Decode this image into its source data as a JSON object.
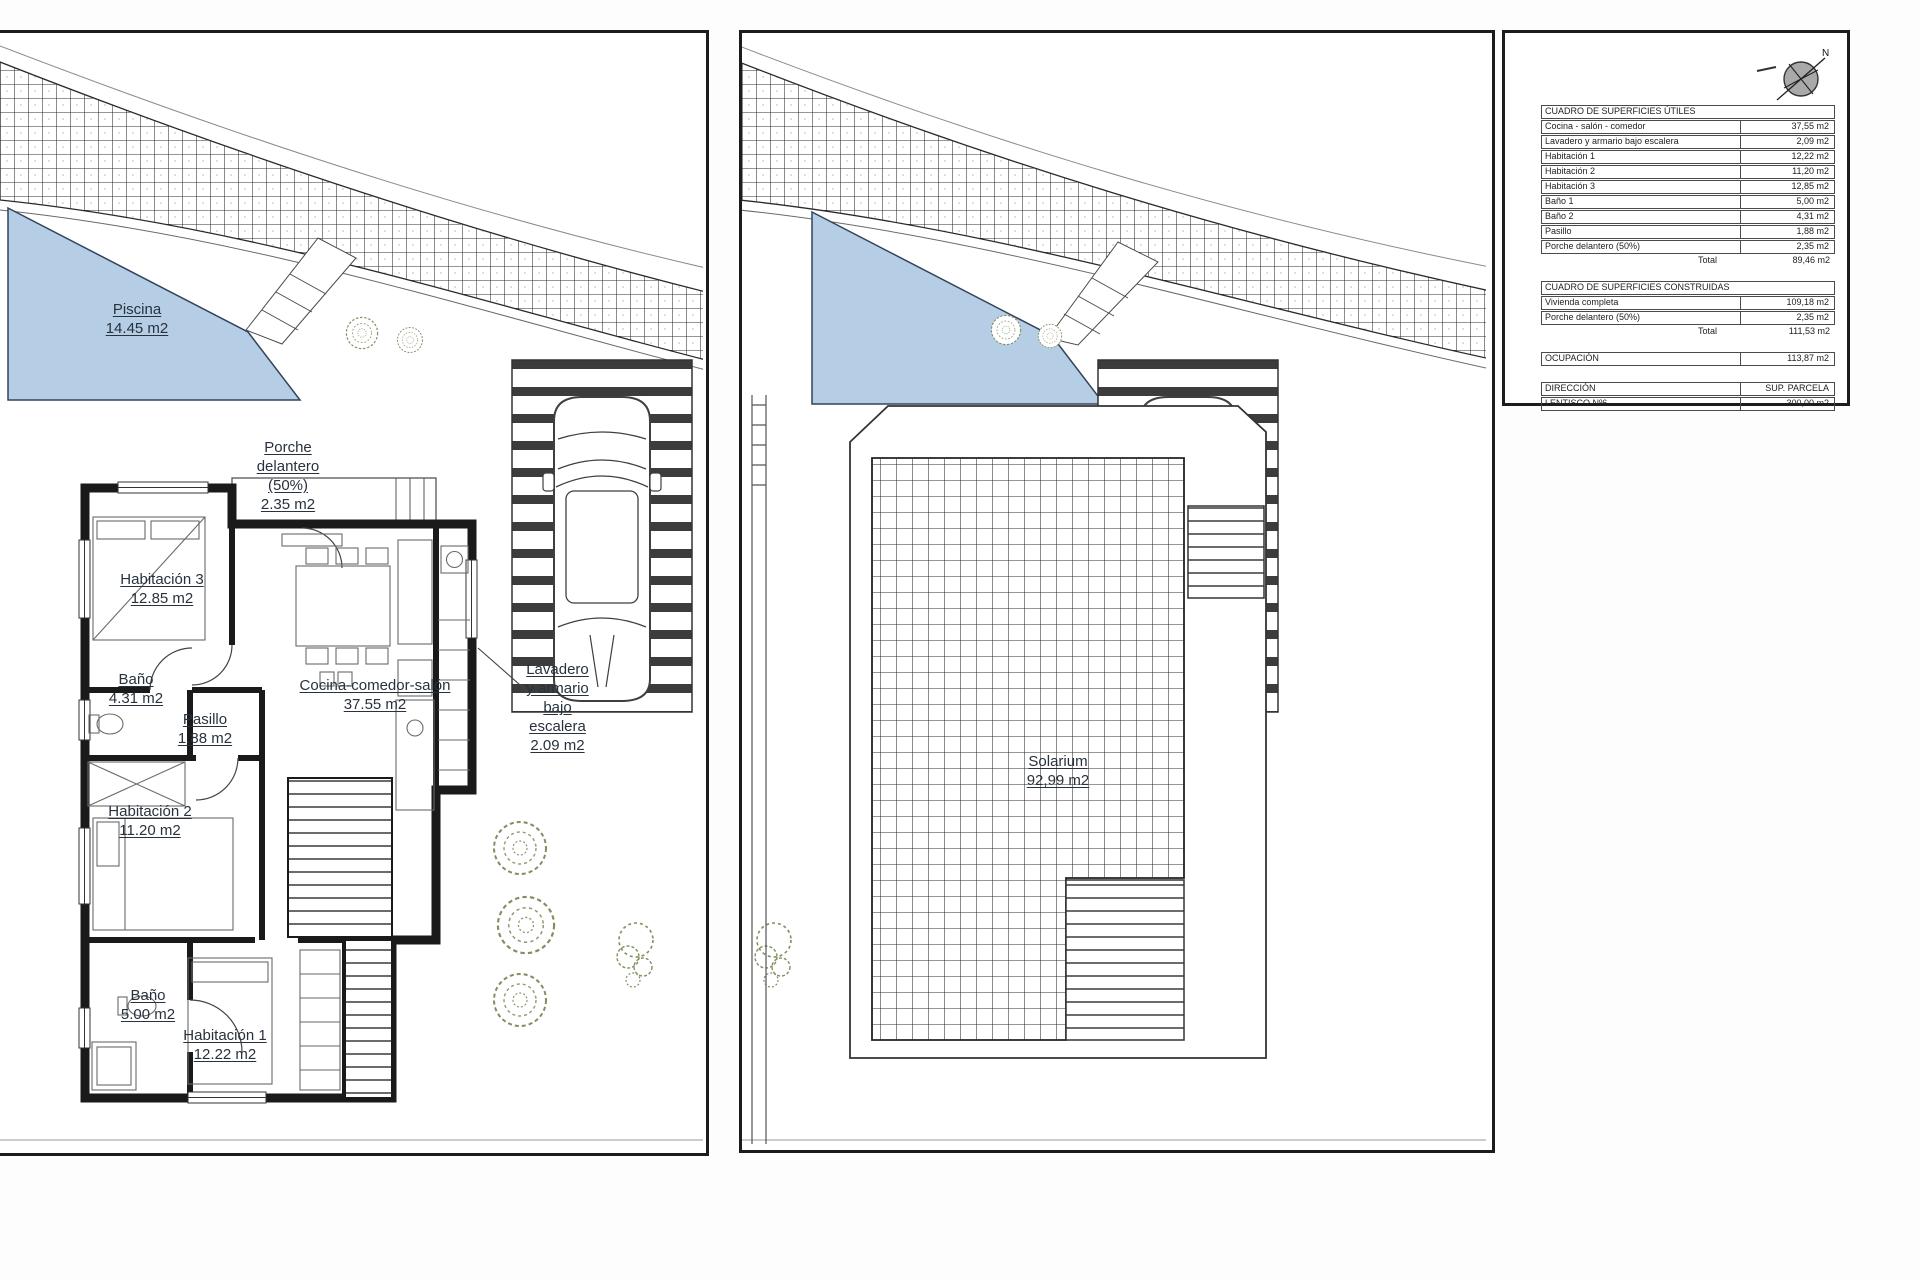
{
  "colors": {
    "pool_fill": "#b5cde5",
    "foliage": "#7f905f",
    "wall": "#1a1a1a",
    "paper": "#ffffff",
    "panel_border": "#1c1c1c"
  },
  "plan1": {
    "piscina": {
      "name": "Piscina",
      "area": "14.45 m2"
    },
    "porche": {
      "l1": "Porche",
      "l2": "delantero",
      "l3": "(50%)",
      "area": "2.35 m2"
    },
    "habitacion3": {
      "name": "Habitación 3",
      "area": "12.85 m2"
    },
    "bano2": {
      "name": "Baño",
      "area": "4.31 m2"
    },
    "pasillo": {
      "name": "Pasillo",
      "area": "1.88 m2"
    },
    "cocina": {
      "name": "Cocina-comedor-salón",
      "area": "37.55 m2"
    },
    "lavadero": {
      "l1": "Lavadero",
      "l2": "y armario",
      "l3": "bajo",
      "l4": "escalera",
      "area": "2.09 m2"
    },
    "habitacion2": {
      "name": "Habitación 2",
      "area": "11.20 m2"
    },
    "bano1": {
      "name": "Baño",
      "area": "5.00 m2"
    },
    "habitacion1": {
      "name": "Habitación 1",
      "area": "12.22 m2"
    }
  },
  "plan2": {
    "solarium": {
      "name": "Solarium",
      "area": "92,99 m2"
    }
  },
  "info_panel": {
    "compass_north": "N",
    "utiles": {
      "header": "CUADRO DE SUPERFICIES ÚTILES",
      "rows": [
        {
          "label": "Cocina - salón - comedor",
          "value": "37,55 m2"
        },
        {
          "label": "Lavadero y armario bajo escalera",
          "value": "2,09 m2"
        },
        {
          "label": "Habitación 1",
          "value": "12,22 m2"
        },
        {
          "label": "Habitación 2",
          "value": "11,20 m2"
        },
        {
          "label": "Habitación 3",
          "value": "12,85 m2"
        },
        {
          "label": "Baño 1",
          "value": "5,00 m2"
        },
        {
          "label": "Baño 2",
          "value": "4,31 m2"
        },
        {
          "label": "Pasillo",
          "value": "1,88 m2"
        },
        {
          "label": "Porche delantero (50%)",
          "value": "2,35 m2"
        }
      ],
      "total_label": "Total",
      "total_value": "89,46 m2"
    },
    "construidas": {
      "header": "CUADRO DE SUPERFICIES CONSTRUIDAS",
      "rows": [
        {
          "label": "Vivienda completa",
          "value": "109,18 m2"
        },
        {
          "label": "Porche delantero (50%)",
          "value": "2,35 m2"
        }
      ],
      "total_label": "Total",
      "total_value": "111,53 m2"
    },
    "ocupacion": {
      "label": "OCUPACIÓN",
      "value": "113,87 m2"
    },
    "direccion": {
      "label": "DIRECCIÓN",
      "value_header": "SUP. PARCELA",
      "row_label": "LENTISCO Nº6",
      "row_value": "300,00 m2"
    }
  }
}
